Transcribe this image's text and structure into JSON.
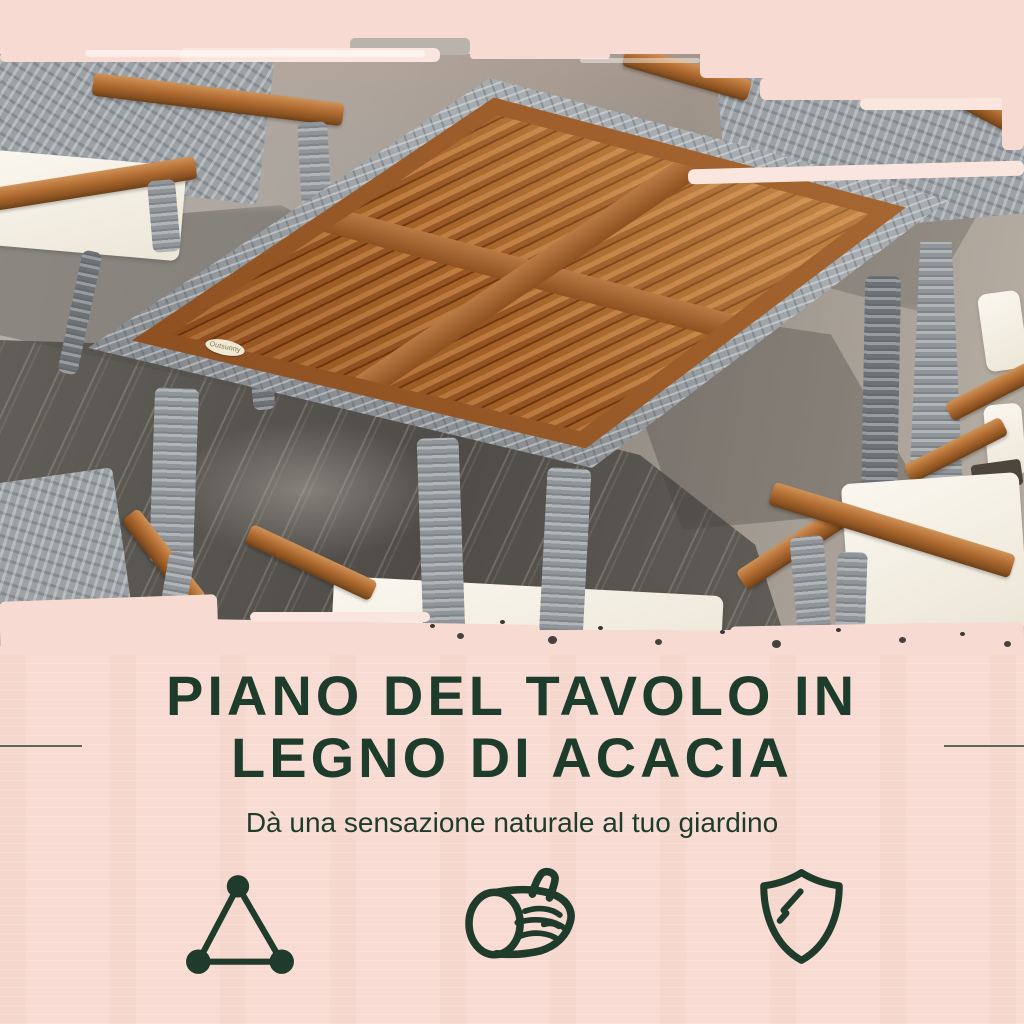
{
  "photo": {
    "brand_tag": "Outsunny"
  },
  "feature": {
    "headline_line1": "PIANO DEL TAVOLO IN",
    "headline_line2": "LEGNO DI ACACIA",
    "subtitle": "Dà una sensazione naturale al tuo giardino",
    "icons": [
      {
        "name": "triangle-nodes-icon"
      },
      {
        "name": "wood-log-icon"
      },
      {
        "name": "shield-icon"
      }
    ]
  },
  "colors": {
    "background_pink": "#f8dcd3",
    "headline_green": "#1e3c2c",
    "icon_green": "#1f3b2b",
    "wood_brown": "#a9672f",
    "rattan_gray": "#9aa0a4",
    "cushion_white": "#f3efe6",
    "wet_concrete": "#55524d"
  }
}
